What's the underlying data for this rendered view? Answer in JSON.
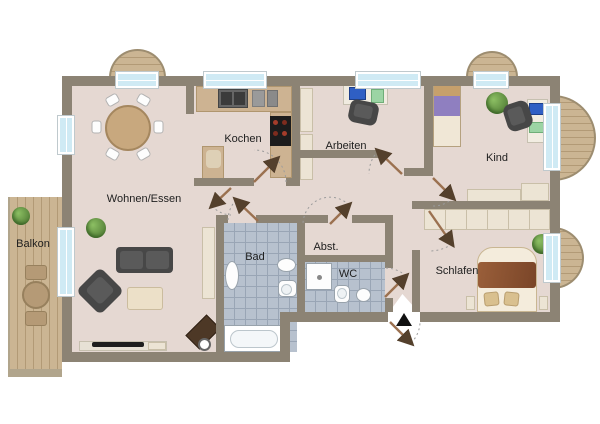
{
  "floorplan": {
    "type": "apartment-floorplan",
    "rooms": {
      "balkon": {
        "label": "Balkon"
      },
      "wohnen_essen": {
        "label": "Wohnen/Essen"
      },
      "kochen": {
        "label": "Kochen"
      },
      "arbeiten": {
        "label": "Arbeiten"
      },
      "kind": {
        "label": "Kind"
      },
      "schlafen": {
        "label": "Schlafen"
      },
      "bad": {
        "label": "Bad"
      },
      "wc": {
        "label": "WC"
      },
      "abstellraum": {
        "label": "Abst."
      }
    },
    "colors": {
      "wall": "#8c8374",
      "floor": "#e5d8d2",
      "tile": "#b7c1ce",
      "tile_line": "#99a5b5",
      "wood": "#cbb593",
      "wood_line": "#b29a76",
      "window_glass": "#cfeaf4",
      "counter": "#cdb392",
      "cream": "#ece4d4",
      "dark_furniture": "#474747",
      "door_leaf": "#9b7150",
      "door_arrow": "#54402c",
      "entrance_arrow": "#111111"
    }
  }
}
